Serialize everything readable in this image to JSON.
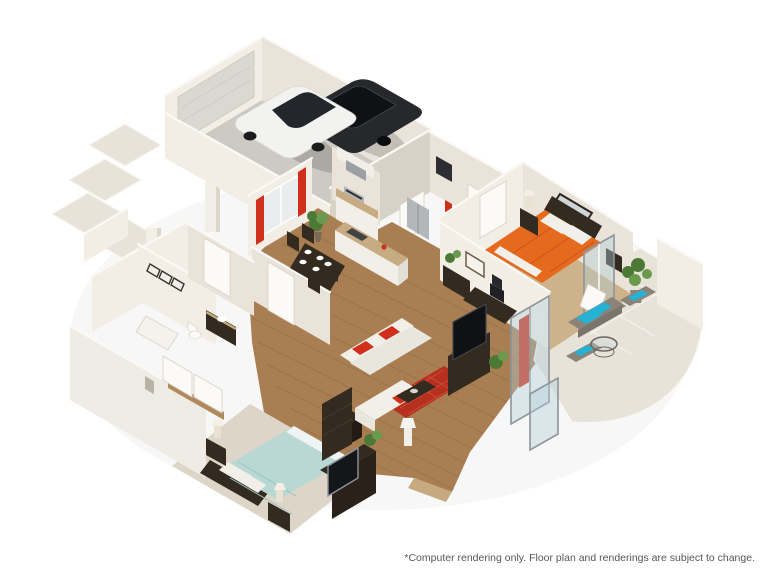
{
  "scene": {
    "kind": "3D isometric floor plan rendering",
    "disclaimer": "*Computer rendering only. Floor plan and renderings are subject to change."
  },
  "palette": {
    "bg": "#ffffff",
    "wall_light": "#f2eee6",
    "wall_mid": "#e9e3d9",
    "wall_shadow": "#d8d1c5",
    "wall_top": "#fbf9f5",
    "wood": "#a87e52",
    "wood_light": "#cdb28b",
    "wood_dark": "#8a663e",
    "carpet": "#ddd6c8",
    "tile": "#e8e3d9",
    "concrete": "#cdcac4",
    "rug_red": "#b5301e",
    "accent_red": "#cf2f1b",
    "bed_orange": "#e66a1e",
    "bed_teal": "#b9d8d3",
    "cushion_turquoise": "#25b2d4",
    "furniture_dark": "#332a20",
    "sofa_white": "#f1efe8",
    "granite": "#c7ac83",
    "stainless": "#b3b7ba",
    "car_white": "#f2f2f0",
    "car_black": "#26282b",
    "plant_green": "#4c7a36",
    "frame_gray": "#8e959a",
    "glass_tint": "rgba(176,205,214,0.40)",
    "text_gray": "#54565a"
  }
}
